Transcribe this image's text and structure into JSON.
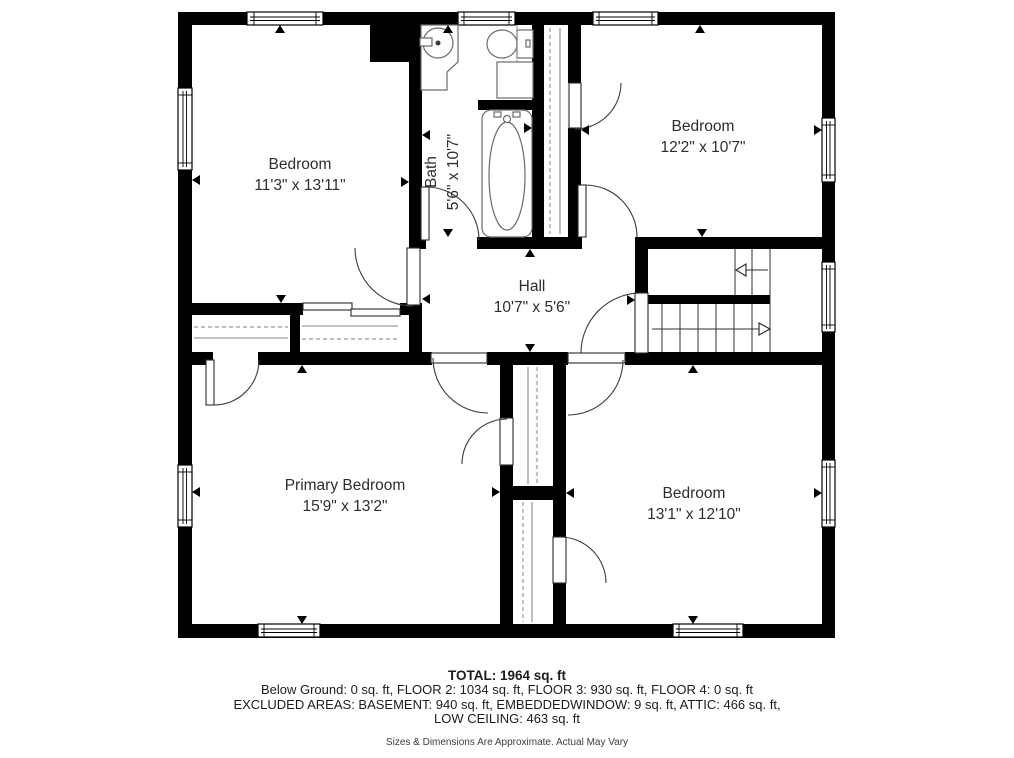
{
  "plan": {
    "rooms": {
      "bedroom_top_left": {
        "name": "Bedroom",
        "dims": "11'3\" x 13'11\""
      },
      "bath": {
        "name": "Bath",
        "dims": "5'6\" x 10'7\""
      },
      "bedroom_top_right": {
        "name": "Bedroom",
        "dims": "12'2\" x 10'7\""
      },
      "hall": {
        "name": "Hall",
        "dims": "10'7\" x 5'6\""
      },
      "primary_bedroom": {
        "name": "Primary Bedroom",
        "dims": "15'9\" x 13'2\""
      },
      "bedroom_bottom_right": {
        "name": "Bedroom",
        "dims": "13'1\" x 12'10\""
      }
    }
  },
  "footer": {
    "total": "TOTAL: 1964 sq. ft",
    "floors": "Below Ground: 0 sq. ft, FLOOR 2: 1034 sq. ft, FLOOR 3: 930 sq. ft, FLOOR 4: 0 sq. ft",
    "excluded_line1": "EXCLUDED AREAS: BASEMENT: 940 sq. ft, EMBEDDEDWINDOW: 9 sq. ft, ATTIC: 466 sq. ft,",
    "excluded_line2": "LOW CEILING: 463 sq. ft",
    "disclaimer": "Sizes & Dimensions Are Approximate. Actual May Vary"
  },
  "colors": {
    "wall": "#000000",
    "background": "#ffffff",
    "label_text": "#2d2d2d"
  }
}
